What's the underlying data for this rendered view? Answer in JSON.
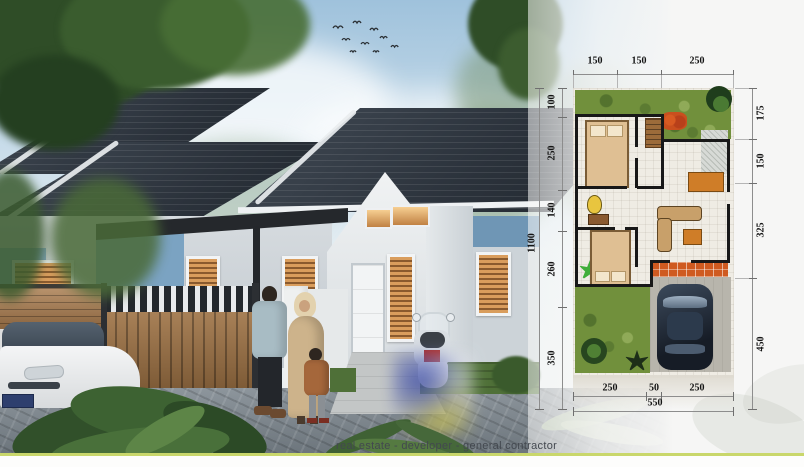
{
  "meta": {
    "width_px": 804,
    "height_px": 467
  },
  "caption": {
    "text": "real estate - developer - general contractor"
  },
  "accent": {
    "line_color": "#c9d76b"
  },
  "floor_plan": {
    "dims_top": [
      "150",
      "150",
      "250"
    ],
    "dims_left": [
      "100",
      "250",
      "140",
      "260",
      "350"
    ],
    "dims_left_total": "1100",
    "dims_right": [
      "175",
      "150",
      "325",
      "450"
    ],
    "dims_bottom": [
      "250",
      "50",
      "250"
    ],
    "dims_bottom_total": "550",
    "colors": {
      "garden": "#71903c",
      "terrace_tiles": "#cf5a20",
      "walls": "#181818",
      "floor": "#efece4",
      "carport": "#b8b5ac"
    }
  },
  "scene": {
    "description": "single-storey house exterior render with family, scooter, car, wooden gate and tropical plants"
  }
}
